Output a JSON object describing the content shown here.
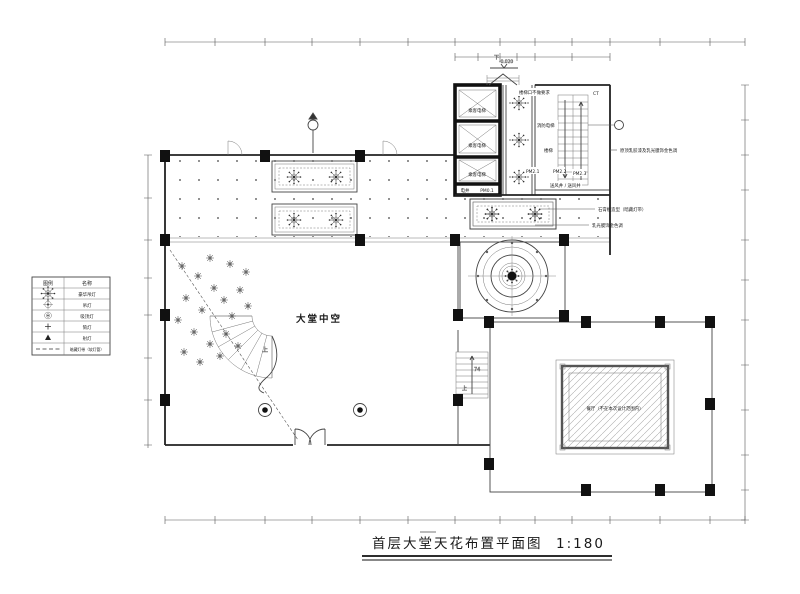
{
  "title": {
    "text": "首层大堂天花布置平面图",
    "scale": "1:180"
  },
  "legend": {
    "header": {
      "symbol": "图例",
      "name": "名称"
    },
    "rows": [
      {
        "icon": "chandelier-icon",
        "name": "豪华吊灯"
      },
      {
        "icon": "pendant-light-icon",
        "name": "吊灯"
      },
      {
        "icon": "ceiling-light-icon",
        "name": "吸顶灯"
      },
      {
        "icon": "downlight-icon",
        "name": "筒灯"
      },
      {
        "icon": "spotlight-icon",
        "name": "射灯"
      },
      {
        "icon": "light-strip-icon",
        "name": "暗藏灯带（软灯管）"
      }
    ]
  },
  "rooms": {
    "atrium": "大堂中空",
    "passenger_elevator": "乘客电梯",
    "fire_elevator": "消防电梯",
    "stair": "楼梯",
    "stair_note": "楼梯口不做要求",
    "electrical_shaft": "电井",
    "air_shaft": "送风井 / 送风井",
    "restaurant": "餐厅（不在本次设计范围内）",
    "ct": "CT"
  },
  "tags": {
    "pm01": "PM0.1",
    "pm21": "PM2.1",
    "pm22": "PM2.2",
    "pm23": "PM2.3"
  },
  "marks": {
    "down": "下",
    "level": "-0.020",
    "up": "上",
    "stair_count": "74"
  },
  "annotations": {
    "a1": "原顶乳胶漆及乳光膜饰金色调",
    "a2": "石膏板造型（暗藏灯带）",
    "a3": "乳光膜饰金色调"
  },
  "colors": {
    "line": "#333333",
    "wall": "#111111",
    "hatch": "#999999",
    "bg": "#ffffff"
  }
}
